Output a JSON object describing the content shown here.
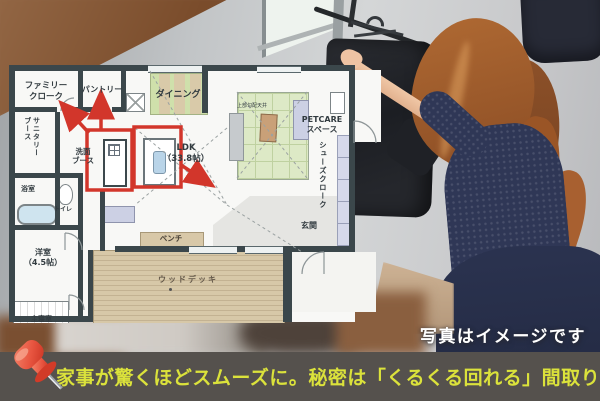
{
  "floorplan": {
    "rooms": {
      "family_closet": "ファミリー\nクローク",
      "pantry": "パントリー",
      "dining": "ダイニング",
      "sanitary_booth": "サニタリー\nブース",
      "washbasin_booth": "洗面\nブース",
      "bathroom": "浴室",
      "toilet": "トイレ",
      "western_room": "洋室\n（4.5帖）",
      "ldk": "LDK\n（33.8帖）",
      "sloped_ceiling_note": "上部勾配天井",
      "petcare_space": "PETCARE\nスペース",
      "shoe_closet": "シューズクローク",
      "entrance": "玄関",
      "bench": "ベンチ",
      "wood_deck": "ウッドデッキ",
      "master_bedroom": "主寝室"
    },
    "annotation_color": "#d2362b"
  },
  "photo": {
    "caption": "写真はイメージです"
  },
  "banner": {
    "text": "家事が驚くほどスムーズに。秘密は「くるくる回れる」間取り",
    "bg_color": "#55514d",
    "text_color": "#dbe23b",
    "icon": "pushpin-icon"
  }
}
